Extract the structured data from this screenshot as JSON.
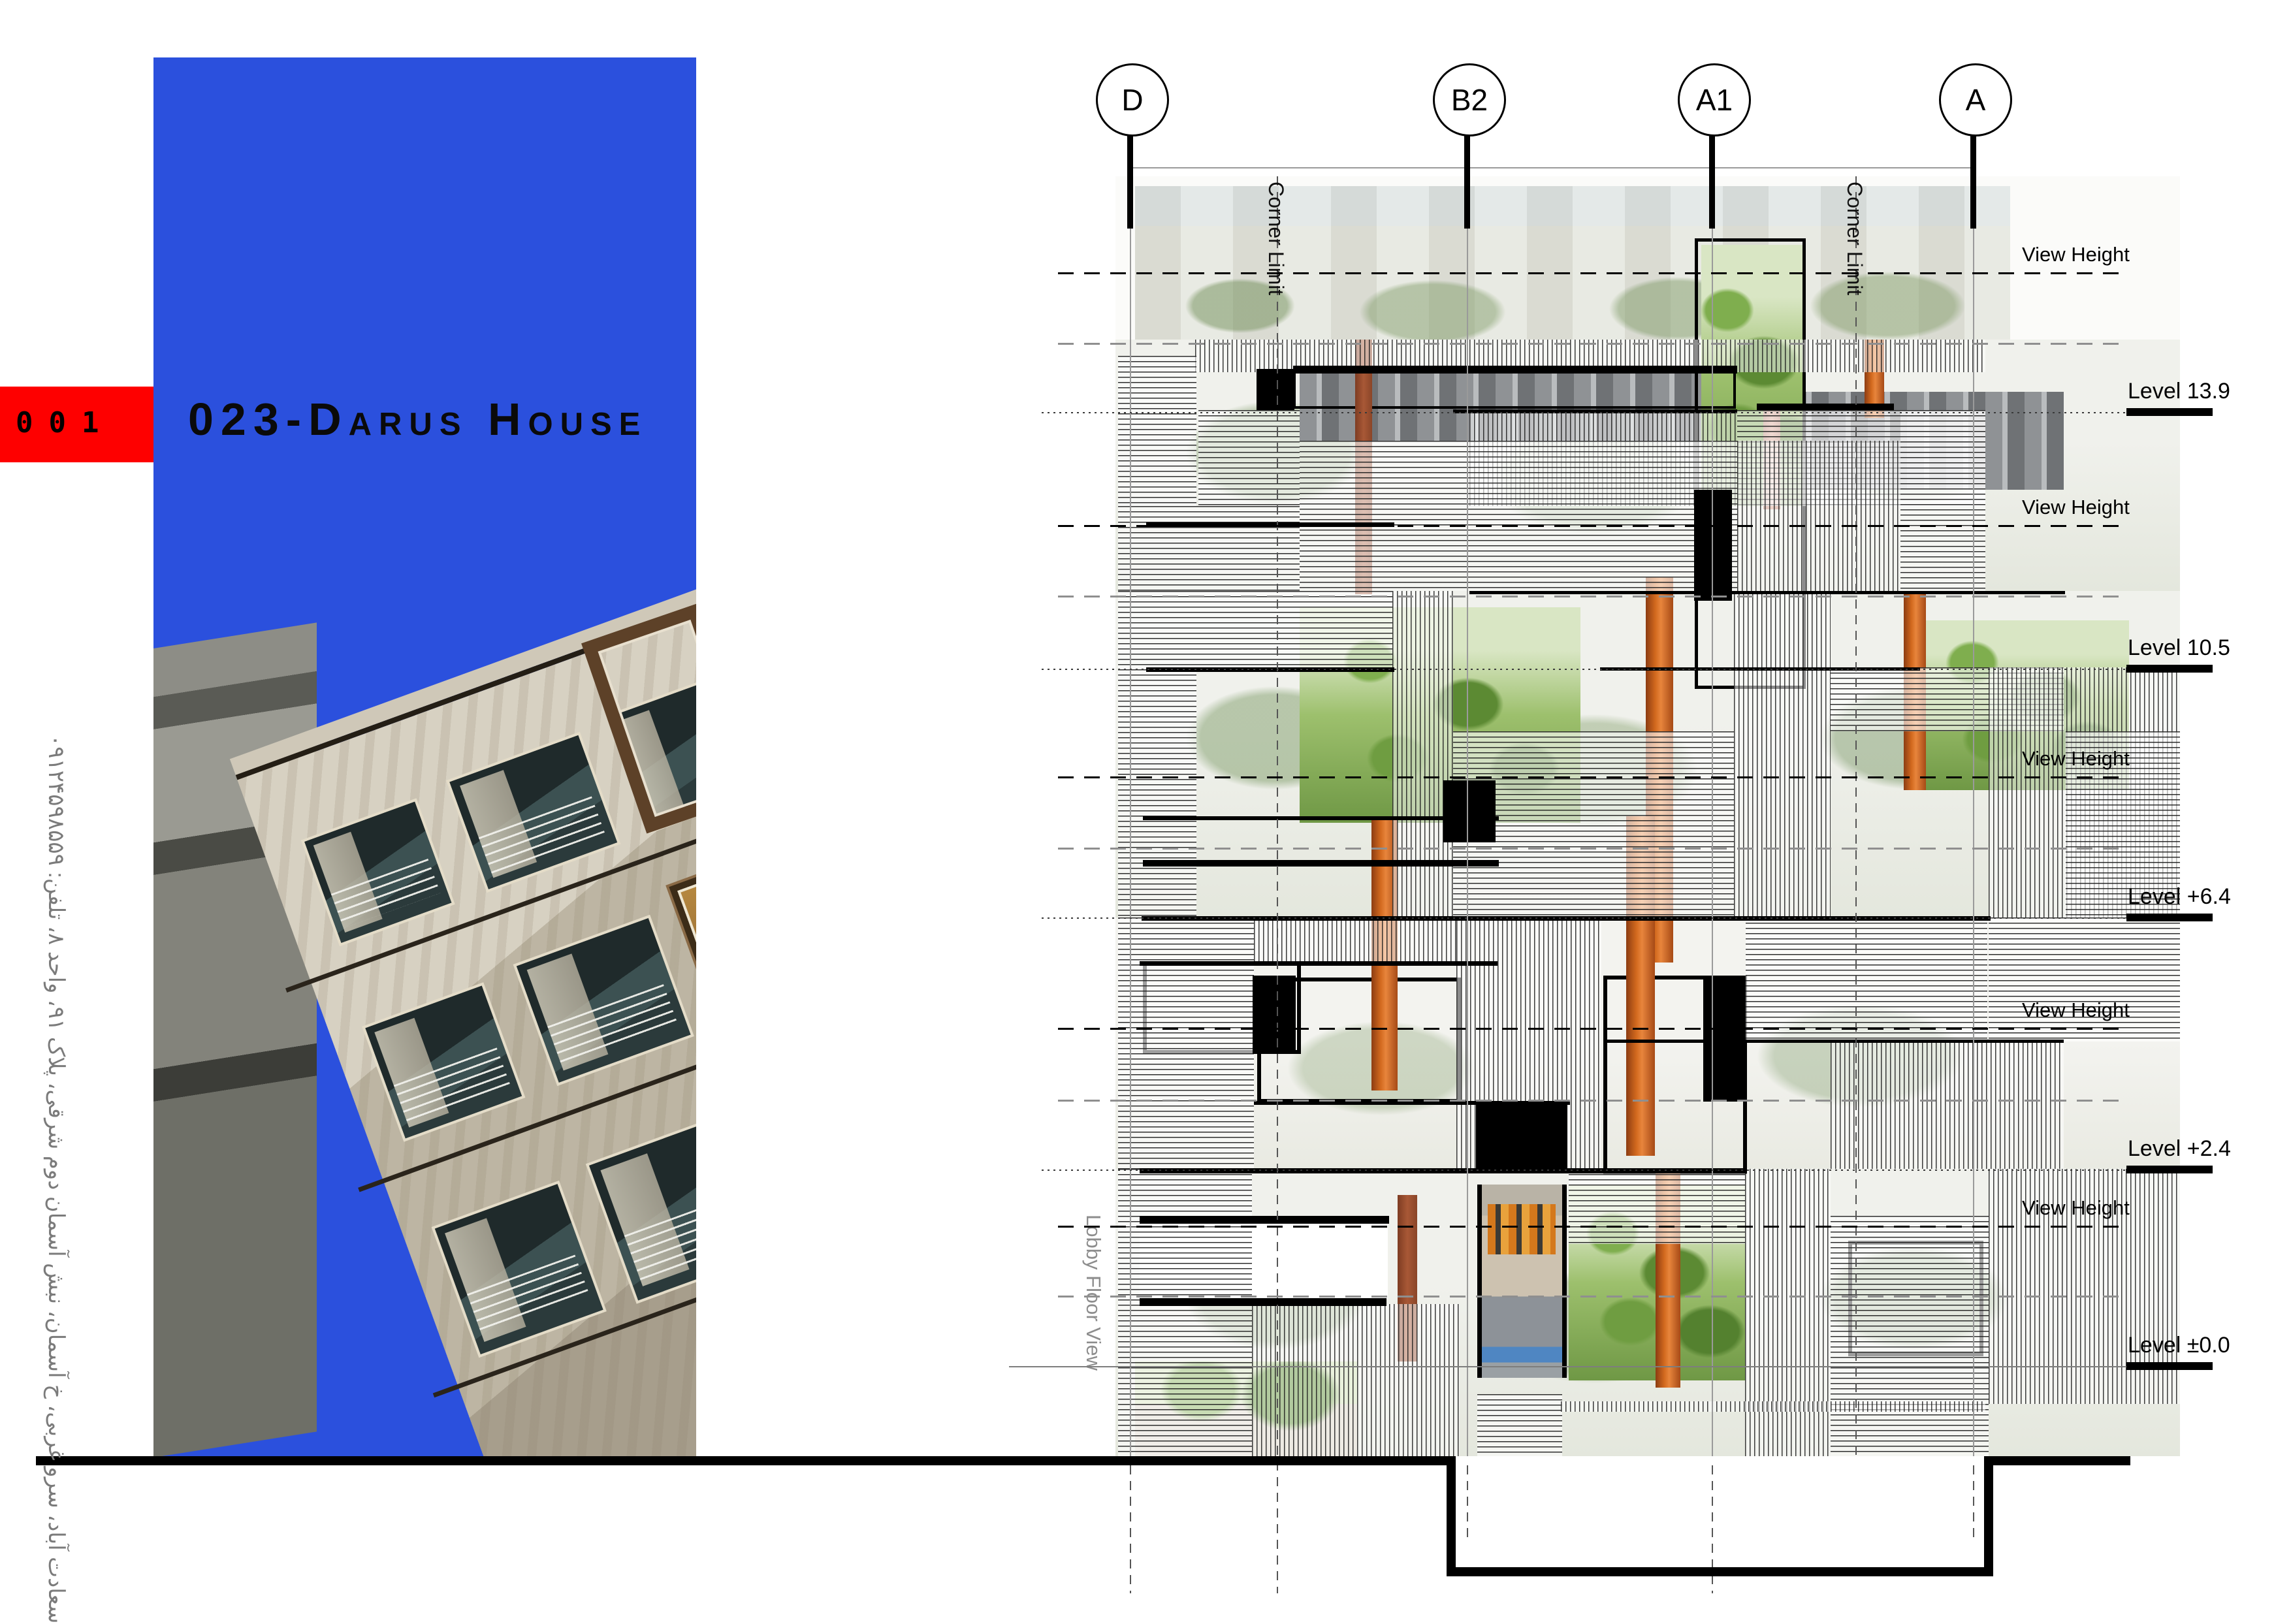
{
  "sheet": {
    "background": "#ffffff"
  },
  "index_badge": {
    "number": "001",
    "background": "#fe0000"
  },
  "project_title": "023-Darus House",
  "address_sidebar": "سعادت آباد، سرو غربی، خ آسمان، نبش آسمان دوم شرقی، پلاک ۹۱، واحد ۸، تلفن: ۰۹۱۲۴۵۹۸۵۵۹",
  "hero": {
    "sky_color": "#2b50dd"
  },
  "elevation": {
    "grid_bubbles": [
      {
        "label": "D"
      },
      {
        "label": "B2"
      },
      {
        "label": "A1"
      },
      {
        "label": "A"
      }
    ],
    "corner_limit_1": "Corner Limit",
    "corner_limit_2": "Corner Limit",
    "lobby_label": "Lobby Floor View",
    "view_height_labels": [
      "View Height",
      "View Height",
      "View Height",
      "View Height",
      "View Height"
    ],
    "level_labels": [
      "Level 13.9",
      "Level 10.5",
      "Level +6.4",
      "Level +2.4",
      "Level ±0.0"
    ],
    "accent_colors": {
      "column_orange": "#d2691e",
      "foliage_green": "#6f9845",
      "hatch_ink": "#191919"
    }
  }
}
